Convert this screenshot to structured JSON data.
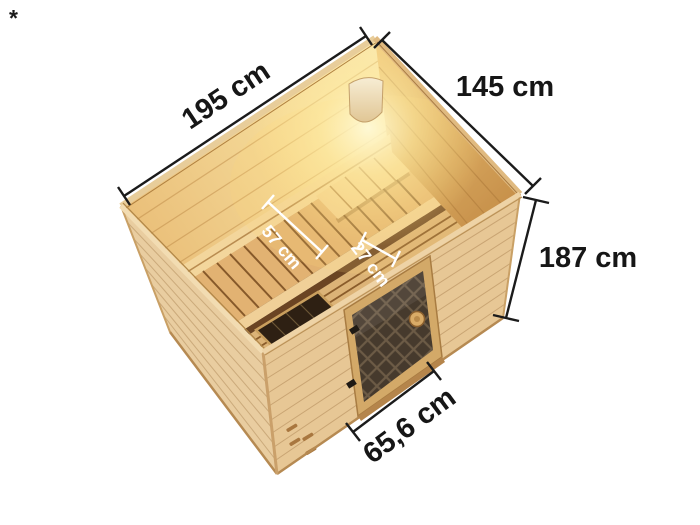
{
  "page": {
    "background": "#ffffff",
    "footnote_marker": "*"
  },
  "figure": {
    "title": "Sauna 3D cutaway product render",
    "description": "Isometric top view of a wooden indoor sauna with corner lamp, slatted two-tier benches, headrest and bronzed glass door",
    "dimension_labels": {
      "back_wall_width": "195 cm",
      "side_wall_width": "145 cm",
      "wall_height": "187 cm",
      "door_width": "65,6 cm",
      "bench_depth": "57 cm",
      "step_depth": "27 cm"
    },
    "colors": {
      "dimension_line": "#1b1b1b",
      "interior_dimension_line": "#ffffff",
      "exterior_wood": "#e9cda0",
      "interior_wood_lit": "#f2cf8d",
      "bench_wood": "#e2b272",
      "door_glass": "#463a2d",
      "lamp_glow": "#ffe9a8",
      "lamp_shade": "#f6ecd2"
    }
  }
}
